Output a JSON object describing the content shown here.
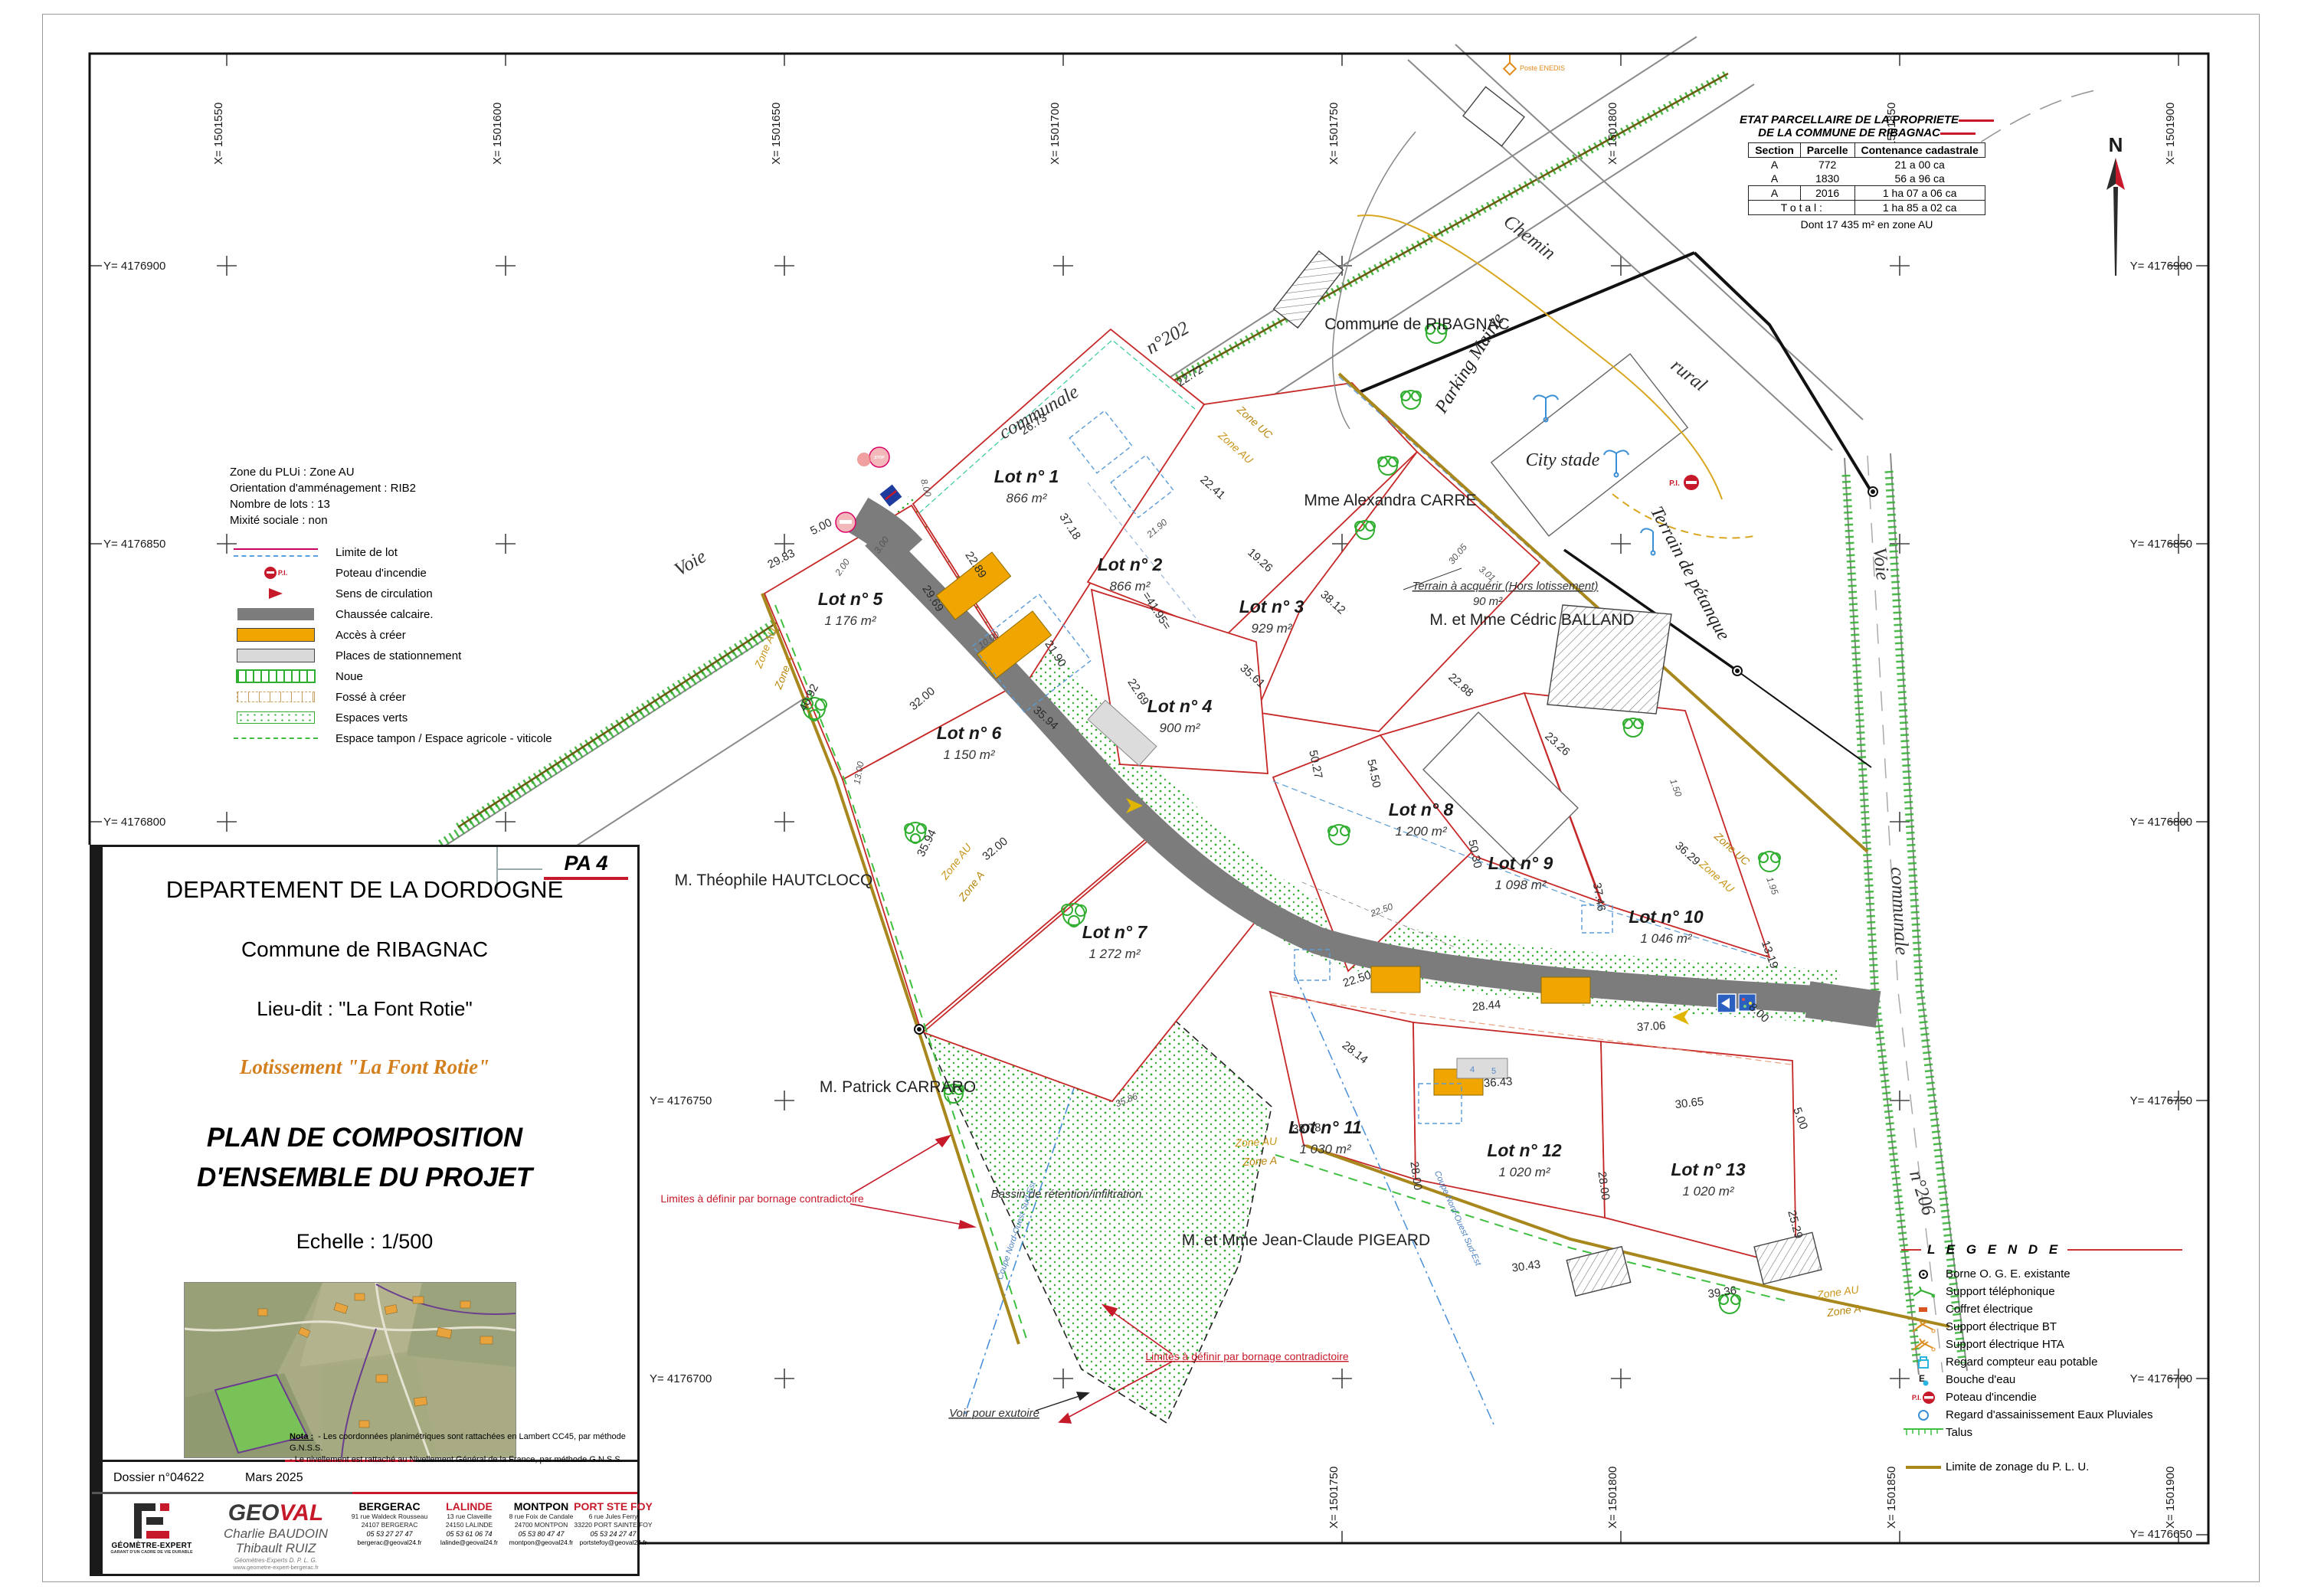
{
  "north_label": "N",
  "parcel_table": {
    "title1": "ETAT PARCELLAIRE DE  LA PROPRIETE",
    "title2": "DE LA COMMUNE DE RIBAGNAC",
    "col_section": "Section",
    "col_parcelle": "Parcelle",
    "col_contenance": "Contenance cadastrale",
    "rows": [
      {
        "section": "A",
        "parcelle": "772",
        "contenance": "21 a 00 ca"
      },
      {
        "section": "A",
        "parcelle": "1830",
        "contenance": "56 a 96 ca"
      },
      {
        "section": "A",
        "parcelle": "2016",
        "contenance": "1 ha 07 a 06 ca"
      }
    ],
    "total_label": "T o t a l :",
    "total_value": "1 ha 85 a 02 ca",
    "note": "Dont 17 435 m² en zone AU"
  },
  "info_box": {
    "lines": [
      "Zone du PLUi : Zone AU",
      "Orientation d'amménagement : RIB2",
      "Nombre de lots : 13",
      "Mixité sociale : non"
    ],
    "pi_label": "P.I.",
    "items": [
      "Limite de lot",
      "Poteau d'incendie",
      "Sens de circulation",
      "Chaussée calcaire.",
      "Accès à créer",
      "Places de stationnement",
      "Noue",
      "Fossé à créer",
      "Espaces verts",
      "Espace tampon / Espace agricole - viticole"
    ]
  },
  "legend": {
    "title": "L E G E N D E",
    "pi_label": "P.I.",
    "items": [
      "Borne O. G. E. existante",
      "Support téléphonique",
      "Coffret électrique",
      "Support électrique BT",
      "Support électrique HTA",
      "Regard compteur eau potable",
      "Bouche d'eau",
      "Poteau d'incendie",
      "Regard d'assainissement Eaux Pluviales",
      "Talus"
    ],
    "limite_item": "Limite de zonage du P. L. U."
  },
  "grid": {
    "top": [
      "X= 1501550",
      "X= 1501600",
      "X= 1501650",
      "X= 1501700",
      "X= 1501750",
      "X= 1501800",
      "X= 1501850",
      "X= 1501900"
    ],
    "bottom": [
      "X= 1501750",
      "X= 1501800",
      "X= 1501850",
      "X= 1501900"
    ],
    "left": [
      "Y= 4176900",
      "Y= 4176850",
      "Y= 4176800"
    ],
    "mid": [
      "Y= 4176750",
      "Y= 4176700"
    ],
    "right": [
      "Y= 4176900",
      "Y= 4176850",
      "Y= 4176800",
      "Y= 4176750",
      "Y= 4176700",
      "Y= 4176650"
    ]
  },
  "title_block": {
    "pa": "PA 4",
    "department": "DEPARTEMENT DE LA DORDOGNE",
    "commune": "Commune de RIBAGNAC",
    "lieu_dit": "Lieu-dit : \"La Font Rotie\"",
    "lotissement": "Lotissement \"La Font Rotie\"",
    "plan1": "PLAN DE COMPOSITION",
    "plan2": "D'ENSEMBLE DU PROJET",
    "echelle": "Echelle : 1/500",
    "dossier": "Dossier n°04622",
    "date": "Mars 2025",
    "nota_label": "Nota :",
    "nota_line1": "- Les coordonnées planimétriques sont rattachées en Lambert CC45, par méthode G.N.S.S.",
    "nota_line2": "- Le nivellement est rattaché au Nivellement Général de la France, par méthode G.N.S.S.",
    "firm": {
      "name_black": "GEO",
      "name_red": "VAL",
      "partner1": "Charlie BAUDOIN",
      "partner2": "Thibault RUIZ",
      "subtitle": "Géomètres-Experts D. P. L. G.",
      "website": "www.geometre-expert-bergerac.fr",
      "label1": "GÉOMÈTRE-EXPERT",
      "label2": "GARANT D'UN CADRE DE VIE DURABLE"
    },
    "offices": [
      {
        "name": "BERGERAC",
        "line1": "91 rue Waldeck Rousseau",
        "line2": "24107 BERGERAC",
        "tel": "05 53 27 27 47",
        "email": "bergerac@geoval24.fr"
      },
      {
        "name": "LALINDE",
        "line1": "13 rue Claveille",
        "line2": "24150 LALINDE",
        "tel": "05 53 61 06 74",
        "email": "lalinde@geoval24.fr"
      },
      {
        "name": "MONTPON",
        "line1": "8 rue Foix de Candale",
        "line2": "24700 MONTPON",
        "tel": "05 53 80 47 47",
        "email": "montpon@geoval24.fr"
      },
      {
        "name": "PORT STE FOY",
        "line1": "6 rue Jules Ferry",
        "line2": "33220 PORT SAINTE FOY",
        "tel": "05 53 24 27 47",
        "email": "portstefoy@geoval24.fr"
      }
    ]
  },
  "map": {
    "lots": [
      {
        "name": "Lot n° 1",
        "area": "866 m²"
      },
      {
        "name": "Lot n° 2",
        "area": "866 m²"
      },
      {
        "name": "Lot n° 3",
        "area": "929 m²"
      },
      {
        "name": "Lot n° 4",
        "area": "900 m²"
      },
      {
        "name": "Lot n° 5",
        "area": "1 176 m²"
      },
      {
        "name": "Lot n° 6",
        "area": "1 150 m²"
      },
      {
        "name": "Lot n° 7",
        "area": "1 272 m²"
      },
      {
        "name": "Lot n° 8",
        "area": "1 200 m²"
      },
      {
        "name": "Lot n° 9",
        "area": "1 098 m²"
      },
      {
        "name": "Lot n° 10",
        "area": "1 046 m²"
      },
      {
        "name": "Lot n° 11",
        "area": "1 030 m²"
      },
      {
        "name": "Lot n° 12",
        "area": "1 020 m²"
      },
      {
        "name": "Lot n° 13",
        "area": "1 020 m²"
      }
    ],
    "owners": {
      "commune": "Commune de RIBAGNAC",
      "carre": "Mme Alexandra CARRE",
      "balland": "M. et Mme Cédric BALLAND",
      "hautclocq": "M. Théophile HAUTCLOCQ",
      "carraro": "M. Patrick CARRARO",
      "pigeard": "M. et Mme Jean-Claude PIGEARD"
    },
    "places": {
      "city_stade": "City stade",
      "parking_mairie": "Parking Mairie",
      "petanque": "Terrain de pétanque",
      "chemin": "Chemin",
      "rural": "rural",
      "voie_nw": "Voie",
      "communale_nw": "communale",
      "n202": "n°202",
      "voie_e": "Voie",
      "communale_e": "communale",
      "n206": "n°206",
      "poste_enedis": "Poste ENEDIS"
    },
    "annotations": {
      "terrain_acquerir": "Terrain à acquérir (Hors lotissement)",
      "terrain_area": "90 m²",
      "bassin": "Bassin de rétention/infiltration",
      "limites": "Limites à définir par bornage contradictoire",
      "exutoire": "Voir pour exutoire",
      "coupe1": "Coupe Nord-Ouest Sud-Est",
      "coupe2": "Coupe Nord-Ouest Sud-Est",
      "stop": "STOP"
    },
    "zone_labels": [
      "Zone UC",
      "Zone AU",
      "Zone UC",
      "Zone AU",
      "Zone AU",
      "Zone A",
      "Zone AU",
      "Zone A",
      "Zone AU",
      "Zone A",
      "Zone AU",
      "Zone A"
    ],
    "dims": [
      "26.73",
      "22.72",
      "37.18",
      "22.41",
      "19.26",
      "38.12",
      "=41.95=",
      "21.90",
      "22.69",
      "35.61",
      "22.89",
      "29.69",
      "29.83",
      "5.00",
      "40.92",
      "32.00",
      "35.94",
      "32.00",
      "35.94",
      "50.27",
      "54.50",
      "50.30",
      "23.26",
      "36.29",
      "37.46",
      "13.19",
      "8.00",
      "22.50",
      "28.44",
      "37.06",
      "28.14",
      "36.43",
      "30.65",
      "5.00",
      "28.00",
      "28.00",
      "25.29",
      "38.78",
      "35.86",
      "39.36",
      "30.43",
      "3.01",
      "30.05",
      "22.88",
      "1.50",
      "8.00",
      "3.00",
      "2.00",
      "10.00",
      "13.00",
      "1.95",
      "21.90",
      "22.50"
    ],
    "parking_numbers": [
      "4",
      "5"
    ]
  }
}
